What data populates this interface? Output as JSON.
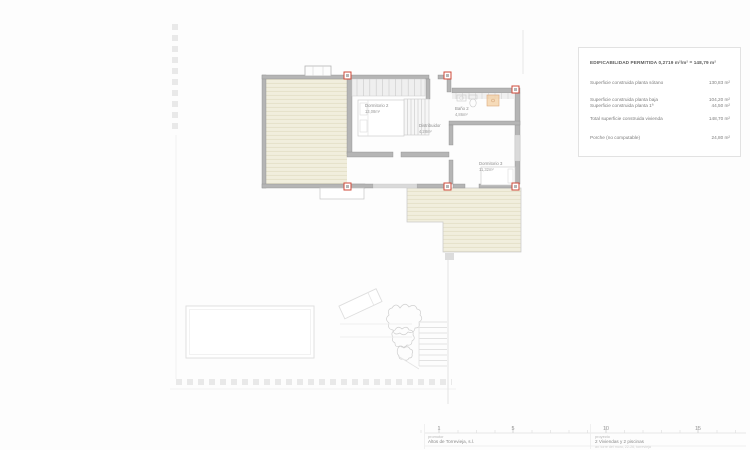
{
  "legend": {
    "title": "EDIFICABILIDAD PERMITIDA 0,2719 m²/m² = 148,79 m²",
    "rows": [
      {
        "label": "Superficie construida planta sótano",
        "value": "130,83 m²"
      },
      {
        "label": "Superficie construida planta baja",
        "value": "104,20 m²"
      },
      {
        "label": "Superficie construida planta 1ª",
        "value": "44,50 m²"
      },
      {
        "label": "Total superficie construida vivienda",
        "value": "148,70 m²"
      },
      {
        "label": "Porche (no computable)",
        "value": "24,80 m²"
      }
    ]
  },
  "plan": {
    "rooms": [
      {
        "name": "Dormitorio 2",
        "area": "13,08m²"
      },
      {
        "name": "Baño 2",
        "area": "4,86m²"
      },
      {
        "name": "Distribuidor",
        "area": "4,28m²"
      },
      {
        "name": "Dormitorio 3",
        "area": "11,32m²"
      }
    ]
  },
  "titleblock": {
    "scale_numbers": [
      "1",
      "5",
      "10",
      "15"
    ],
    "promotor_label": "promotor",
    "promotor_name": "Altos de Torrevieja, s.l.",
    "proyecto_label": "proyecto",
    "proyecto_name": "2 Viviendas y 2 piscinas",
    "proyecto_address": "av. torre del moro, 22-26, torrevieja"
  },
  "colors": {
    "pillar_red": "#cf4a3a",
    "wall_gray": "#b5b5b5",
    "deck_beige": "#f1eedd",
    "site_line": "#e2e2e2"
  }
}
